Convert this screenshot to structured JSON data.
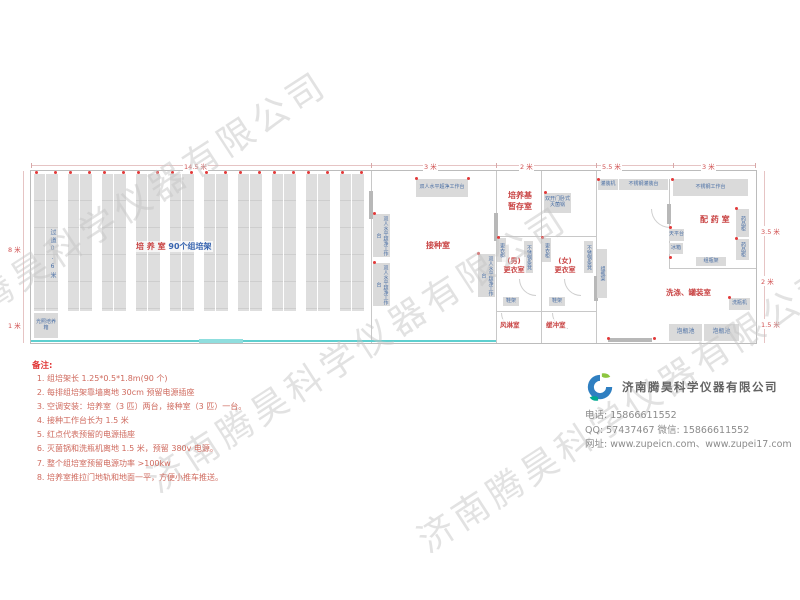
{
  "watermark": {
    "text": "济南腾昊科学仪器有限公司"
  },
  "plan": {
    "dims": {
      "top": [
        "14.5 米",
        "3 米",
        "2 米",
        "5.5 米",
        "3 米"
      ],
      "left": [
        "8 米",
        "1 米"
      ],
      "right": [
        "3.5 米",
        "2 米",
        "1.5 米"
      ]
    },
    "culture": {
      "name_red": "培 养 室",
      "name_blue": "90个组培架",
      "aisle": "过道0.6米",
      "incubator": "光照培养箱",
      "rack_count": 10
    },
    "inoculation": {
      "name": "接种室",
      "bench": "双人水平超净工作台"
    },
    "storage": {
      "name_line1": "培养基",
      "name_line2": "暂存室",
      "sterilizer": "双开门卧式灭菌锅"
    },
    "dressing": {
      "men_line1": "(男)",
      "men_line2": "更衣室",
      "women_line1": "(女)",
      "women_line2": "更衣室",
      "locker": "更衣柜",
      "bench": "不锈钢条凳",
      "shoe_rack": "鞋架"
    },
    "air_shower": "风淋室",
    "buffer": "缓冲室",
    "prep": {
      "name": "配 药 室",
      "worktable": "不锈钢工作台",
      "cabinet": "药品柜",
      "balance": "天平台",
      "fridge": "冰箱",
      "bottle_rack": "组瓶架"
    },
    "washing": {
      "name": "洗涤、罐装室",
      "filler": "灌装机",
      "filling_table": "不锈钢灌装台",
      "washer": "洗瓶机",
      "pool": "泡瓶池",
      "bottle_rack": "组瓶架"
    }
  },
  "notes": {
    "title": "备注:",
    "items": [
      "组培架长 1.25*0.5*1.8m(90 个)",
      "每排组培架靠墙离地 30cm 预留电源插座",
      "空调安装：培养室（3 匹）两台，接种室（3 匹）一台。",
      "接种工作台长为 1.5 米",
      "红点代表预留的电源插座",
      "灭菌锅和洗瓶机离地 1.5 米，预留 380v 电源。",
      "整个组培室预留电源功率 >100kw",
      "培养室推拉门地轨和地面一平，方便小推车推送。"
    ]
  },
  "company": {
    "name": "济南腾昊科学仪器有限公司",
    "contact_lines": [
      "电话: 15866611552",
      "QQ: 57437467   微信: 15866611552",
      "网址: www.zupeicn.com、www.zupei17.com"
    ],
    "logo_colors": {
      "blue": "#2f7fc1",
      "green": "#8dc63f",
      "teal": "#00a890"
    }
  },
  "colors": {
    "room_label": "#c94545",
    "equipment_text": "#4a6fa5",
    "dimension": "#d05050",
    "socket_dot": "#e23a3a",
    "track_line": "#5ecfcf",
    "notes": "#cf6a5e"
  }
}
